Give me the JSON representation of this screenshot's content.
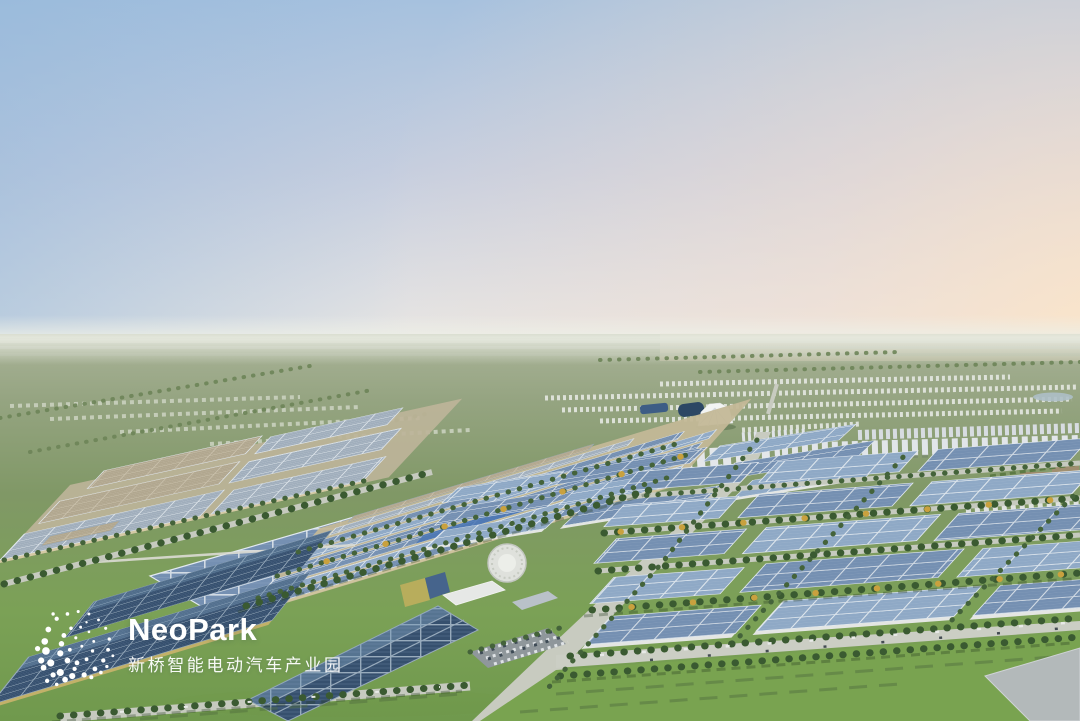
{
  "logo": {
    "wordmark": "NeoPark",
    "subtitle_cn": "新桥智能电动汽车产业园",
    "icon": "dotted-globe-icon",
    "text_color": "#ffffff"
  },
  "scene": {
    "description": "Aerial dusk rendering of the NeoPark intelligent electric-vehicle industrial park: solar-roofed factories and warehouses, a central avenue, residential towers on the horizon and green fields beyond.",
    "sky_colors": {
      "top_left_blue": "#a6c1de",
      "mid": "#c6cedf",
      "horizon_right_peach": "#fde5c6"
    },
    "ground_colors": {
      "distant_plain": "#abb49a",
      "mid_fields": "#809866",
      "foreground_lawn": "#70994d"
    },
    "building_colors": {
      "solar_roof_blue": "#7590b2",
      "solar_roof_dark": "#36506e",
      "roof_light_gray": "#a0aebc",
      "roof_tan": "#b1a78f",
      "facade_tan": "#d5caa5",
      "residential_white": "#e1e5e9",
      "accent_blue": "#4a76b4",
      "autumn_tree_yellow": "#c9a13e"
    },
    "landmarks": [
      "exhibition-tent",
      "arch-hall",
      "circular-pavilion",
      "main-avenue",
      "solar-factories",
      "residential-towers",
      "parking-lot",
      "foreground-lawn"
    ]
  }
}
